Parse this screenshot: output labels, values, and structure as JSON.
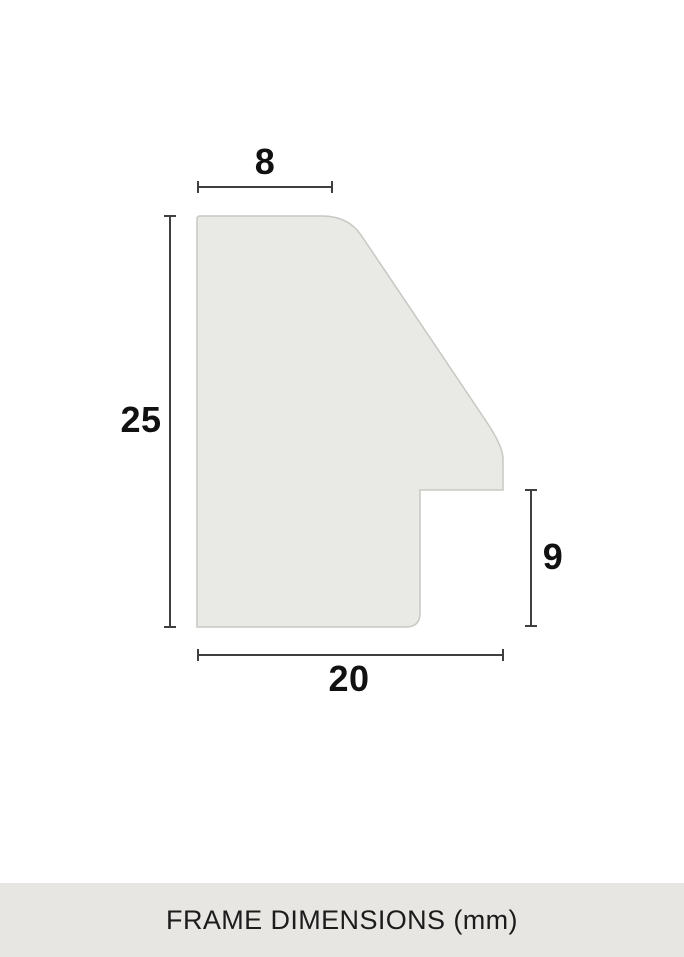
{
  "colors": {
    "background": "#ffffff",
    "profile_fill": "#e9e9e5",
    "profile_stroke": "#c7c7c3",
    "dimension_line": "#3f3f3f",
    "label_text": "#111111",
    "footer_bg": "#e7e6e2",
    "footer_text": "#1c1c1c"
  },
  "diagram": {
    "type": "frame-moulding-cross-section",
    "labels": {
      "top_width": "8",
      "left_height": "25",
      "rabbet_depth": "9",
      "bottom_width": "20"
    }
  },
  "footer": {
    "caption": "FRAME DIMENSIONS (mm)"
  }
}
